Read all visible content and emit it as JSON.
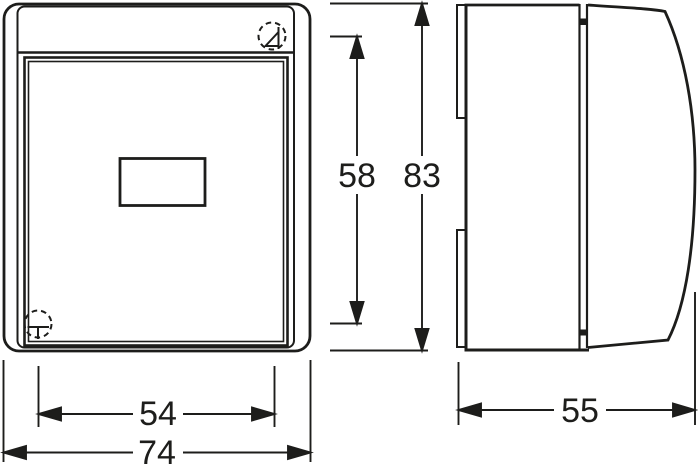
{
  "drawing": {
    "background": "#ffffff",
    "stroke_color": "#1d1d1b",
    "type": "technical-dimension-drawing",
    "views": {
      "front": {
        "features": [
          "outer-cover",
          "inner-frame",
          "top-strip",
          "hinged-lid",
          "label-window"
        ],
        "icons": [
          "screw-fixing-icon-top-right",
          "screw-fixing-icon-bottom-left"
        ]
      },
      "side": {
        "features": [
          "mounting-tab-top",
          "mounting-tab-bottom",
          "base-body",
          "hinge-joint",
          "curved-lid-profile"
        ]
      }
    },
    "dimensions": {
      "inner_fixing_width": "54",
      "overall_width": "74",
      "lid_height": "58",
      "overall_height": "83",
      "overall_depth": "55"
    }
  }
}
